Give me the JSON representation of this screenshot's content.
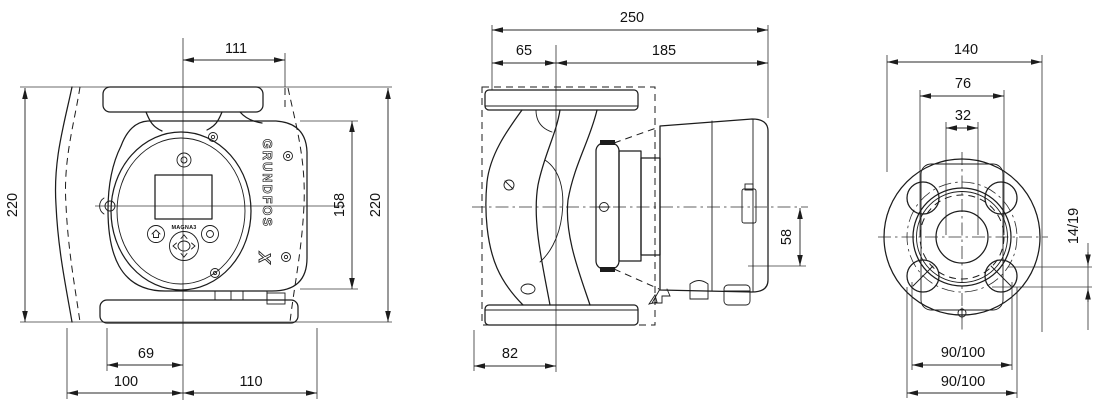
{
  "front_view": {
    "brand": "GRUNDFOS",
    "model": "MAGNA3",
    "dims": {
      "port_to_box_width": "111",
      "height_left": "220",
      "box_height": "158",
      "height_right": "220",
      "base_front_offset": "69",
      "base_left_width": "100",
      "base_right_width": "110"
    }
  },
  "side_view": {
    "dims": {
      "overall_depth": "250",
      "flange_face_to_center": "65",
      "center_to_box_end": "185",
      "center_to_box_bottom": "58",
      "base_depth": "82"
    }
  },
  "flange_view": {
    "dims": {
      "flange_outer": "140",
      "body_width": "76",
      "port_bore": "32",
      "bolt_slot": "14/19",
      "bolt_circle_upper": "90/100",
      "bolt_circle_lower": "90/100"
    }
  }
}
